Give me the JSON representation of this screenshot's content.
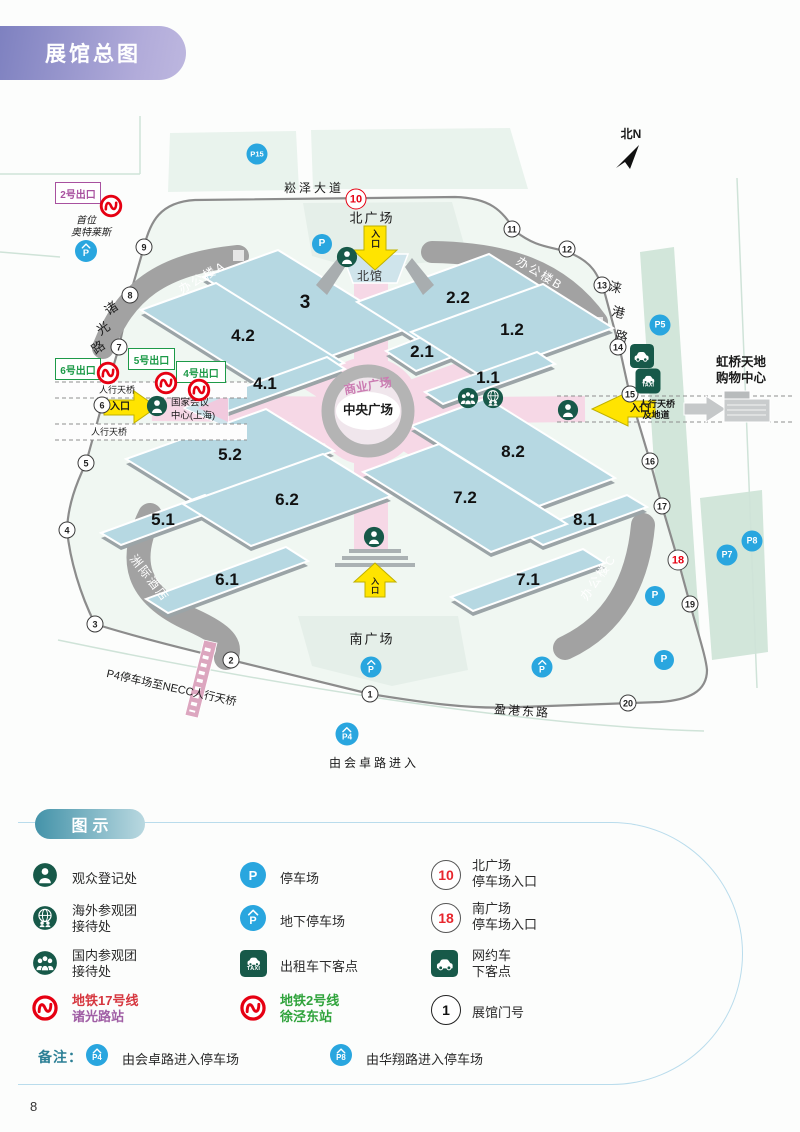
{
  "page": {
    "title": "展馆总图",
    "page_number": "8"
  },
  "colors": {
    "banner_purple": "#7e81c0",
    "legend_teal": "#4493a9",
    "metro_red": "#e60012",
    "parking_blue": "#29a6df",
    "service_green": "#175949",
    "exit_green": "#1d9a48",
    "exit_purple": "#a8519f",
    "hall_blue": "#b6d8e2",
    "plaza_pink": "#f6d8e6",
    "line17_text": "#d6373f",
    "line17_station": "#a05fa5",
    "line2_text": "#2fa33b"
  },
  "map": {
    "compass": "北N",
    "roads": {
      "north": "崧泽大道",
      "south": "盈港东路",
      "south_entry": "由会卓路进入",
      "west_chars": [
        "诸",
        "光",
        "路"
      ],
      "east_chars": [
        "涞",
        "港",
        "路"
      ]
    },
    "areas": {
      "north_plaza": "北广场",
      "south_plaza": "南广场",
      "north_hall": "北馆",
      "central_plaza": "中央广场",
      "commercial_plaza": "商业广场",
      "office_a": "办公楼A",
      "office_b": "办公楼B",
      "office_c": "办公楼C",
      "hotel": "洲际酒店",
      "convention_l1": "国家会议",
      "convention_l2": "中心(上海)",
      "mall_l1": "虹桥天地",
      "mall_l2": "购物中心",
      "outlet_l1": "首位",
      "outlet_l2": "奥特莱斯"
    },
    "exits": {
      "e2": "2号出口",
      "e4": "4号出口",
      "e5": "5号出口",
      "e6": "6号出口"
    },
    "bridges": {
      "west1": "人行天桥",
      "west2": "人行天桥",
      "east_l1": "人行天桥",
      "east_l2": "及地道",
      "p4": "P4停车场至NECC人行天桥"
    },
    "entrance": "入口",
    "halls": [
      "3",
      "4.2",
      "4.1",
      "2.2",
      "2.1",
      "1.2",
      "1.1",
      "5.2",
      "5.1",
      "6.2",
      "6.1",
      "8.2",
      "8.1",
      "7.2",
      "7.1"
    ],
    "gates": [
      "1",
      "2",
      "3",
      "4",
      "5",
      "6",
      "7",
      "8",
      "9",
      "10",
      "11",
      "12",
      "13",
      "14",
      "15",
      "16",
      "17",
      "18",
      "19",
      "20"
    ],
    "parking": {
      "p": "P",
      "p15": "P15",
      "p5": "P5",
      "p7": "P7",
      "p8": "P8",
      "p4": "P4"
    }
  },
  "icons": {
    "p": "P",
    "taxi": "TAXI"
  },
  "legend": {
    "title": "图示",
    "note_label": "备注：",
    "items": {
      "registration": "观众登记处",
      "overseas_l1": "海外参观团",
      "overseas_l2": "接待处",
      "domestic_l1": "国内参观团",
      "domestic_l2": "接待处",
      "line17_l1": "地铁17号线",
      "line17_l2": "诸光路站",
      "parking": "停车场",
      "underground": "地下停车场",
      "taxi_drop": "出租车下客点",
      "line2_l1": "地铁2号线",
      "line2_l2": "徐泾东站",
      "north_gate_num": "10",
      "north_l1": "北广场",
      "north_l2": "停车场入口",
      "south_gate_num": "18",
      "south_l1": "南广场",
      "south_l2": "停车场入口",
      "car_l1": "网约车",
      "car_l2": "下客点",
      "gate_num": "1",
      "gate_label": "展馆门号",
      "p4": "P4",
      "p4_text": "由会卓路进入停车场",
      "p8": "P8",
      "p8_text": "由华翔路进入停车场"
    }
  }
}
